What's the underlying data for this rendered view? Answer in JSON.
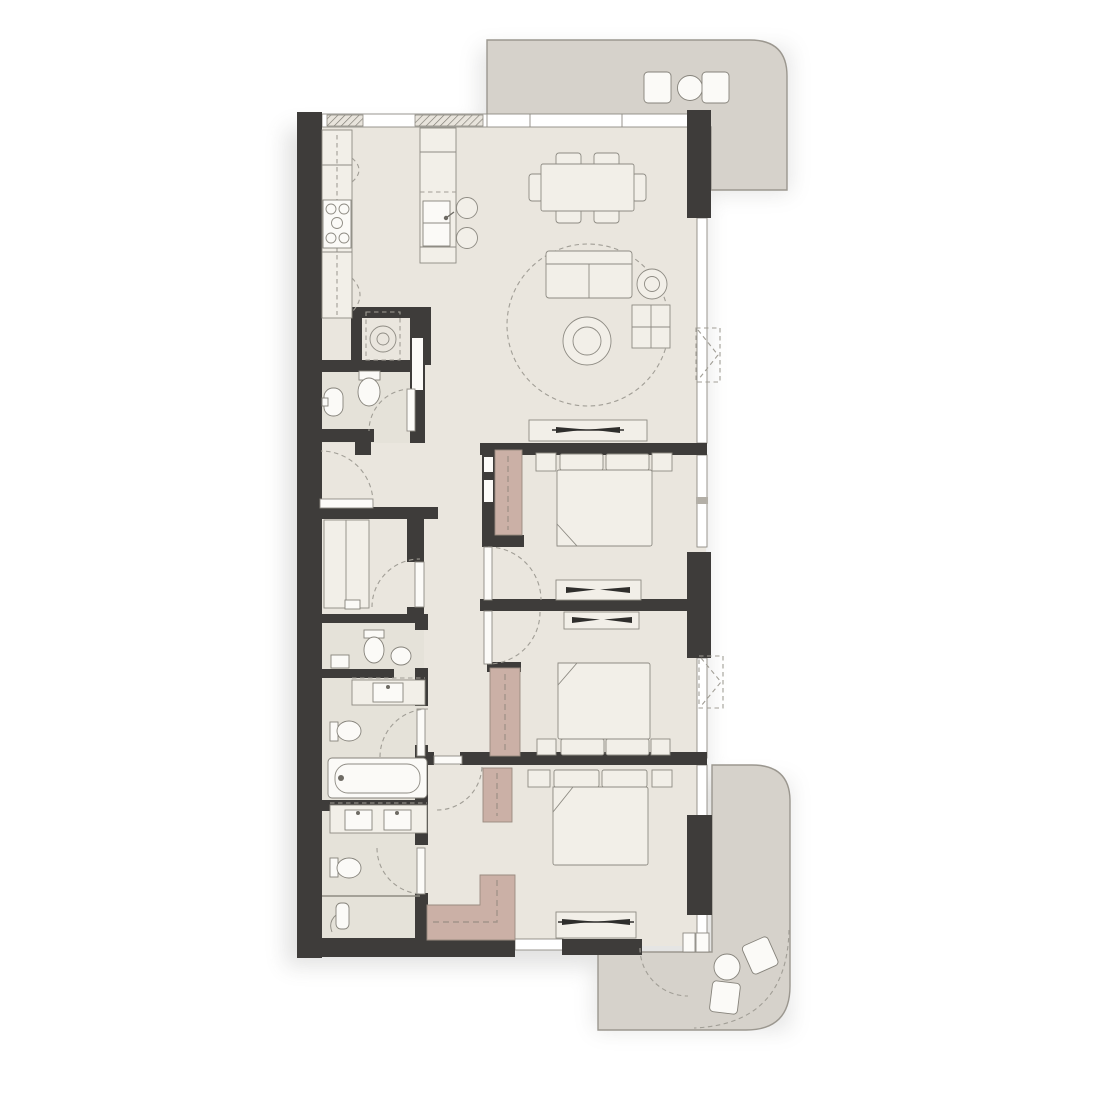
{
  "meta": {
    "diagram_type": "residential-apartment-floor-plan",
    "orientation": "vertical",
    "text_labels_visible": "none"
  },
  "palette": {
    "background": "#ffffff",
    "floor": "#eae6de",
    "bath_floor_tint": "#e3dfd7",
    "walls": "#3e3c3a",
    "balcony_floor": "#d6d2cb",
    "balcony_border": "#9b978f",
    "furniture_fill": "#f2efe8",
    "furniture_outline": "#8e8b83",
    "fixture_fill": "#fbfaf7",
    "wardrobe_fill": "#cbb0a6",
    "wardrobe_outline": "#9a8b80",
    "door_arc": "#a19e96",
    "tv_symbol": "#2f2e2c"
  },
  "rooms": [
    {
      "id": "kitchen",
      "contents": [
        "counter-run",
        "stove-5-burner",
        "kitchen-island",
        "island-sink",
        "bar-stools-2"
      ]
    },
    {
      "id": "dining-area",
      "contents": [
        "dining-table",
        "dining-chairs-6"
      ]
    },
    {
      "id": "living-area",
      "contents": [
        "round-rug",
        "sofa",
        "round-side-table",
        "square-side-unit",
        "round-coffee-table",
        "tv-console"
      ]
    },
    {
      "id": "laundry-closet",
      "contents": [
        "washing-machine"
      ]
    },
    {
      "id": "powder-room",
      "contents": [
        "toilet",
        "wall-basin"
      ]
    },
    {
      "id": "maid-room",
      "contents": [
        "single-bed"
      ]
    },
    {
      "id": "bathroom-2",
      "contents": [
        "toilet",
        "round-basin",
        "side-shelf"
      ]
    },
    {
      "id": "vanity-nook",
      "contents": [
        "counter",
        "basin"
      ]
    },
    {
      "id": "bathroom-3",
      "contents": [
        "toilet",
        "bathtub"
      ]
    },
    {
      "id": "master-bathroom",
      "contents": [
        "double-vanity",
        "toilet",
        "shower"
      ]
    },
    {
      "id": "bedroom-1",
      "contents": [
        "double-bed",
        "nightstands-2",
        "wardrobe",
        "tv-console"
      ]
    },
    {
      "id": "bedroom-2",
      "contents": [
        "double-bed",
        "nightstands-2",
        "wardrobe",
        "tv-console"
      ]
    },
    {
      "id": "master-bedroom",
      "contents": [
        "double-bed",
        "nightstands-2",
        "wardrobe-tall",
        "wardrobe-l-shape",
        "tv-console"
      ]
    },
    {
      "id": "balcony-top",
      "contents": [
        "outdoor-chairs-2",
        "round-table"
      ]
    },
    {
      "id": "balcony-bottom",
      "contents": [
        "outdoor-chairs-2",
        "round-table"
      ]
    }
  ],
  "symbols": {
    "door_swings": 9,
    "windows": "glazed bands on top, right and bottom edges; hatched sill segments at kitchen",
    "ac_units": 2,
    "tv_marks": 4
  }
}
